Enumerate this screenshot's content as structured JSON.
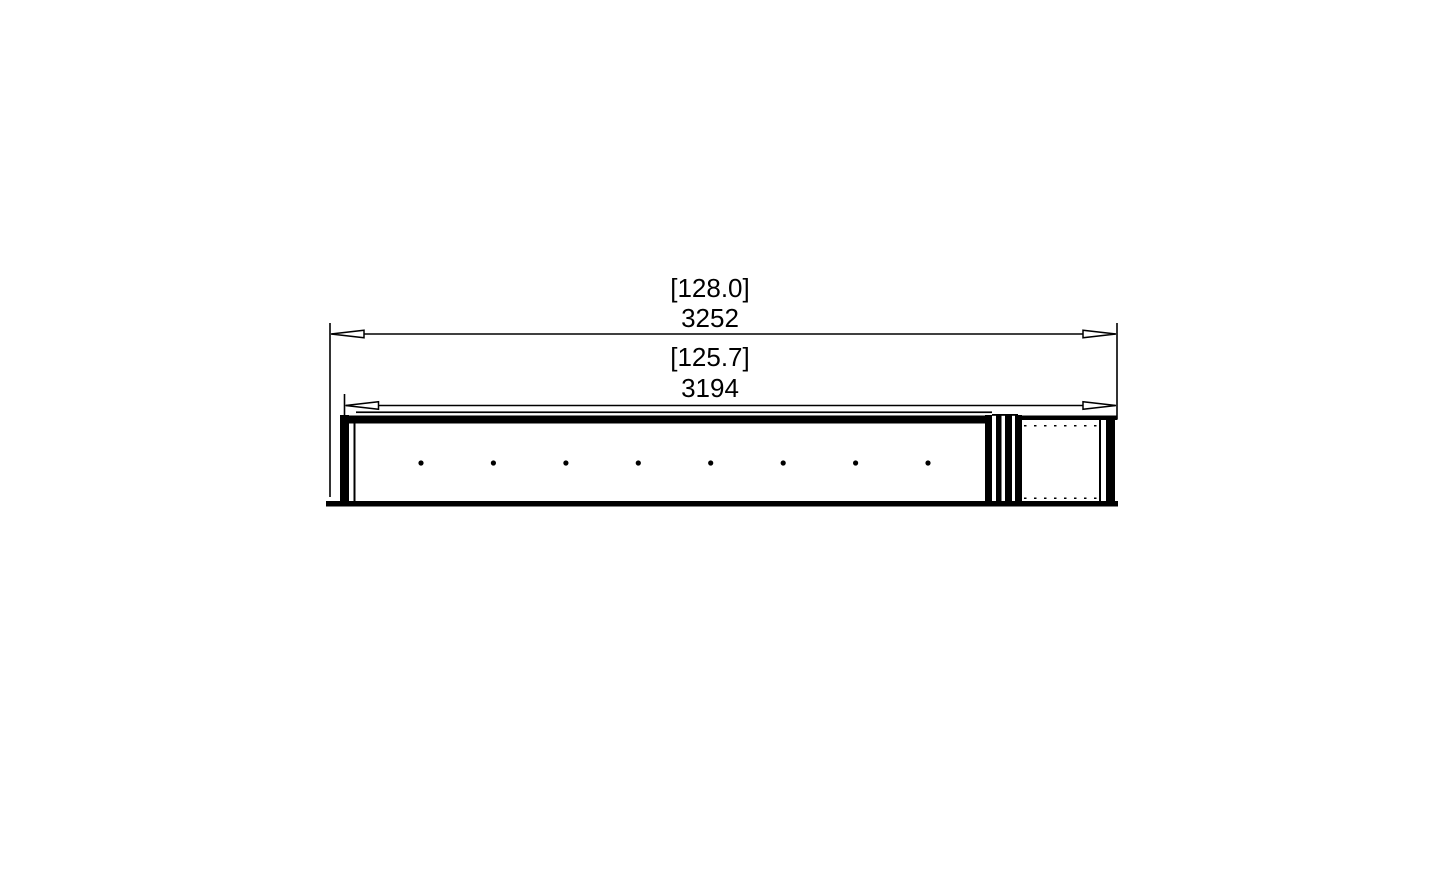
{
  "page": {
    "background_color": "#ffffff"
  },
  "drawing": {
    "line_color": "#000000",
    "dimensions": {
      "overall": {
        "imperial": "[128.0]",
        "metric": "3252"
      },
      "burner": {
        "imperial": "[125.7]",
        "metric": "3194"
      }
    },
    "ports": {
      "count": 8
    }
  }
}
